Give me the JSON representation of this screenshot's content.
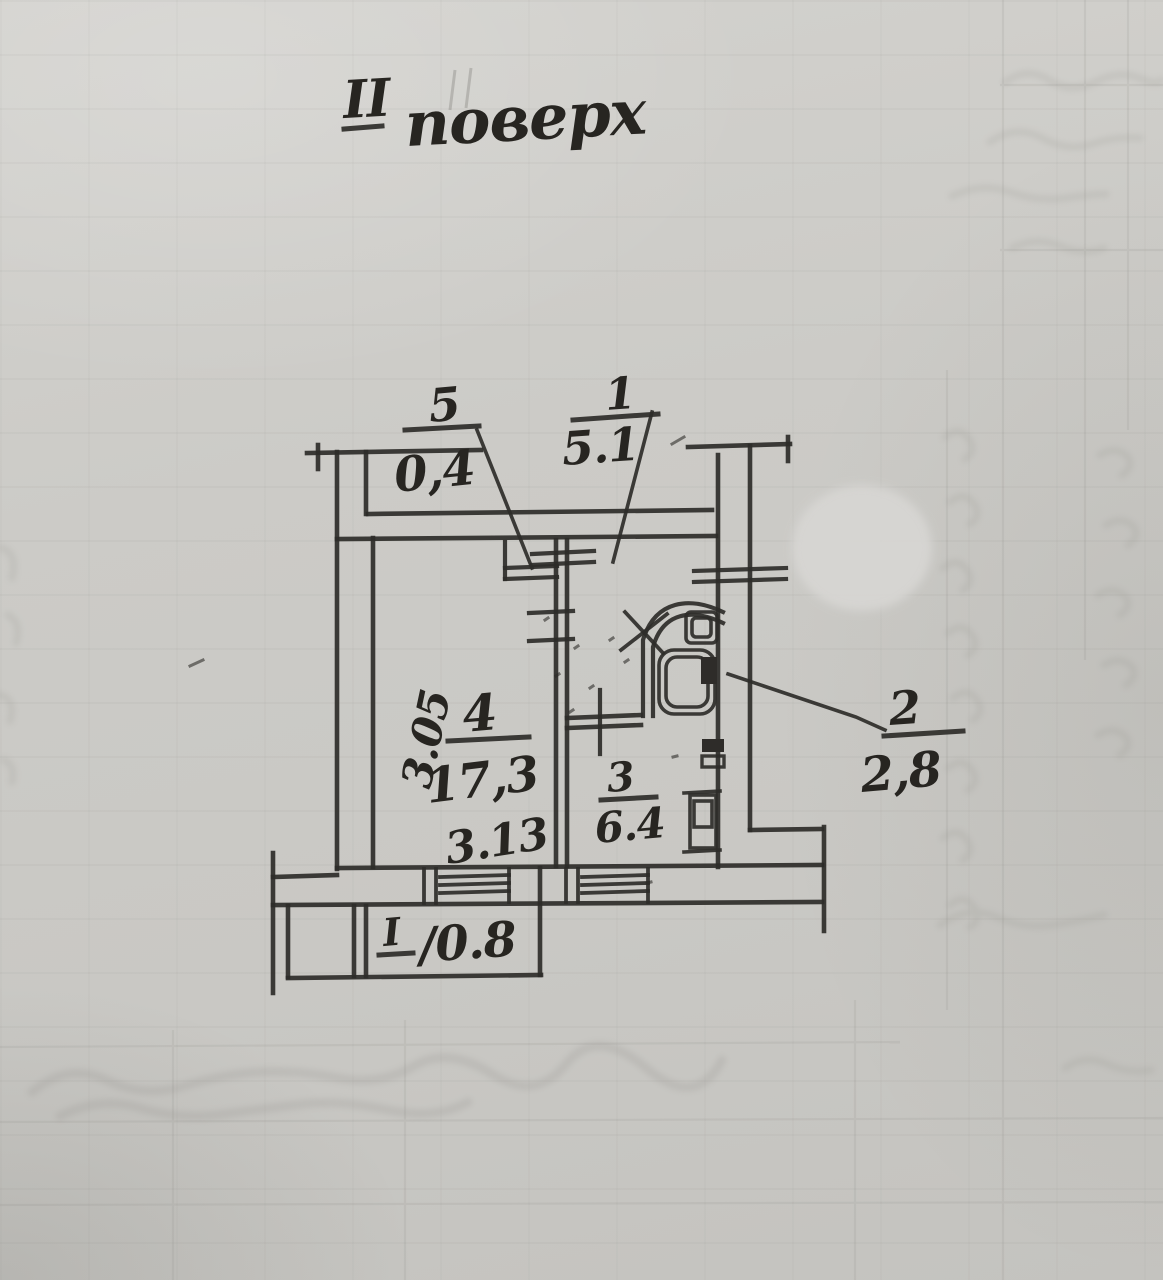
{
  "document": {
    "title": {
      "numeral": "II",
      "word": "поверх"
    }
  },
  "plan": {
    "rooms": {
      "hallway": {
        "number": "1",
        "area": "5.1"
      },
      "bathroom": {
        "number": "2",
        "area": "2,8"
      },
      "kitchen": {
        "number": "3",
        "area": "6.4"
      },
      "living_room": {
        "number": "4",
        "area": "17,3"
      },
      "closet": {
        "number": "5",
        "area": "0,4"
      },
      "balcony": {
        "number": "I",
        "area_label": "/0.8"
      }
    },
    "dimensions": {
      "living_room_width": "3.13",
      "living_room_height": "3.05"
    }
  },
  "colors": {
    "paper": "#cac9c4",
    "ink": "#2e2c29",
    "correction_blob": "#d6d5d2"
  }
}
